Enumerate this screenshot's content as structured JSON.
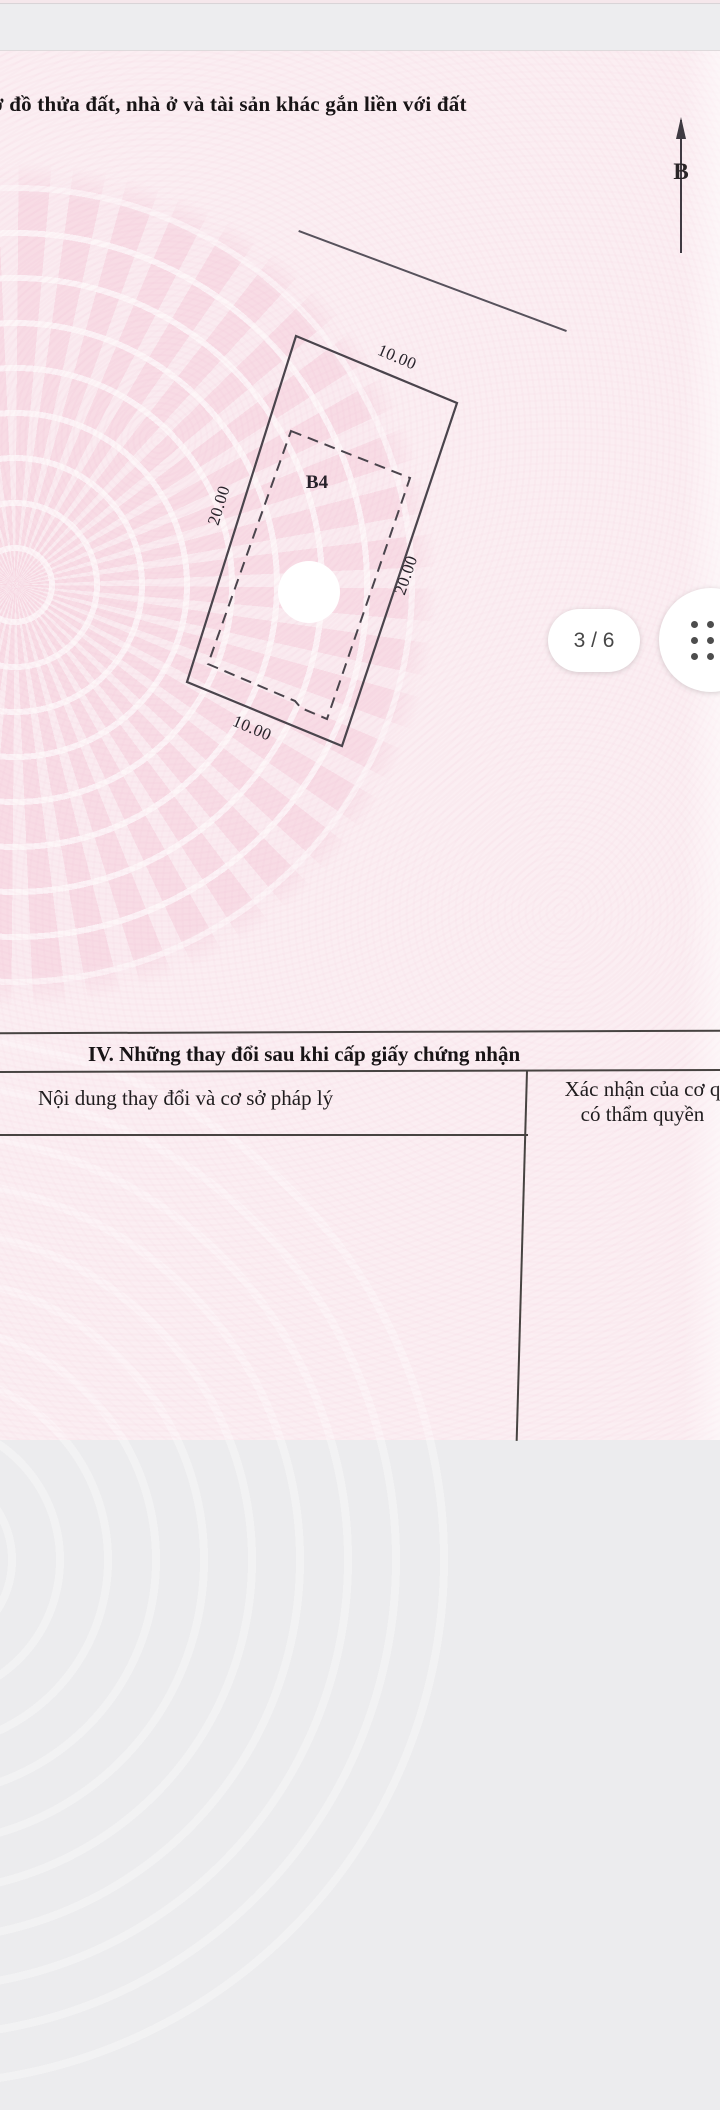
{
  "viewer": {
    "page_indicator": "3 / 6"
  },
  "document": {
    "title_fragment": "ơ đồ thửa đất, nhà ở và tài sản khác gắn liền với đất",
    "compass_label": "B",
    "diagram": {
      "parcel_label": "B4",
      "dim_top": "10.00",
      "dim_left": "20.00",
      "dim_right": "20.00",
      "dim_bottom": "10.00"
    },
    "section_iv": {
      "title": "IV. Những thay đổi sau khi cấp giấy chứng nhận",
      "col1_header": "Nội dung thay đổi và cơ sở pháp lý",
      "col2_header_line1": "Xác nhận của cơ q",
      "col2_header_line2": "có thẩm quyền"
    }
  },
  "colors": {
    "page_pink": "#fbeef2",
    "watermark_pink": "#f3c6d6",
    "gap_gray": "#ededef",
    "line_dark": "#474341",
    "text_black": "#1f1c1e",
    "badge_text": "#474747",
    "dot_gray": "#4d4d4d"
  }
}
